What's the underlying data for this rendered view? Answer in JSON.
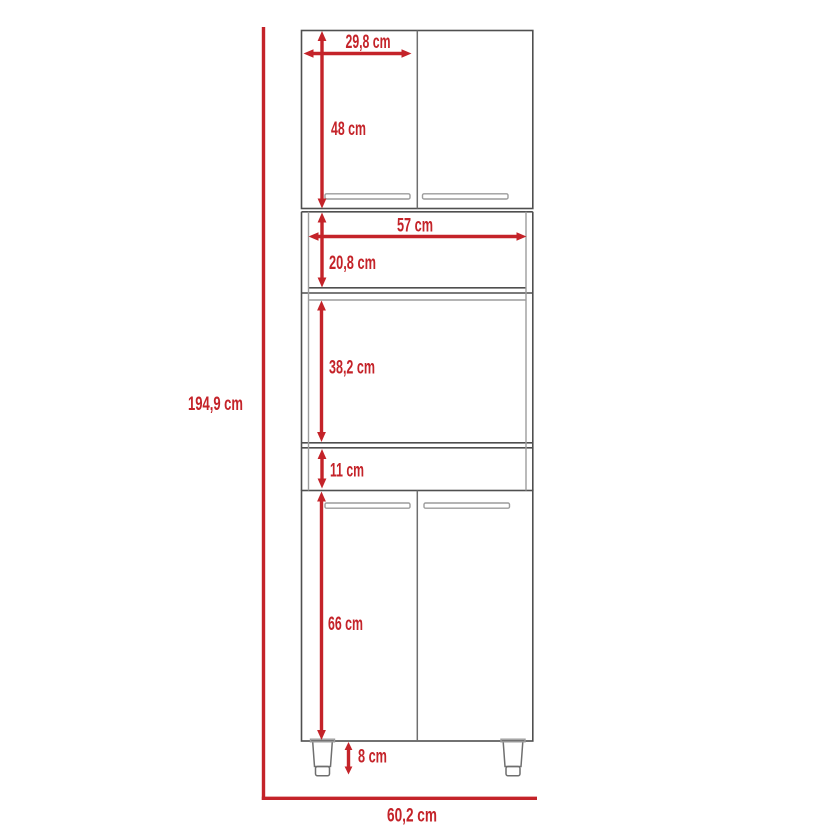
{
  "diagram": {
    "type": "furniture-dimension-drawing",
    "labels": {
      "overall_height": "194,9 cm",
      "overall_width": "60,2 cm",
      "door_width": "29,8 cm",
      "upper_section_height": "48 cm",
      "interior_width": "57 cm",
      "upper_shelf_height": "20,8 cm",
      "middle_opening_height": "38,2 cm",
      "lower_shelf_height": "11 cm",
      "lower_section_height": "66 cm",
      "leg_height": "8 cm"
    },
    "colors": {
      "dimension_red": "#c42329",
      "outline_dark": "#4f4f4f",
      "outline_mid": "#6f6f6f",
      "outline_light": "#9c9c9c"
    }
  }
}
